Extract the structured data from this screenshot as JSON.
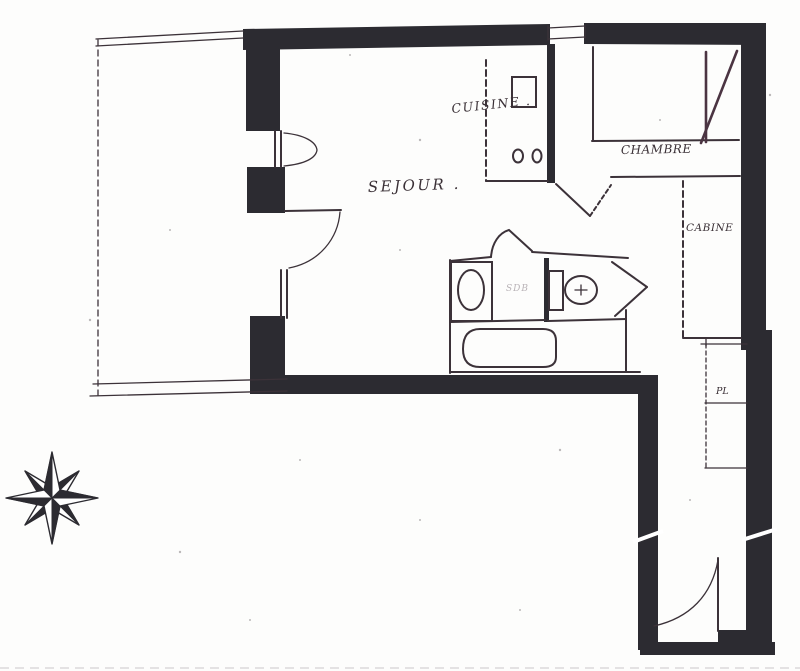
{
  "document": {
    "type": "apartment floor plan",
    "style": "hand-drawn photocopy"
  },
  "colors": {
    "paper": "#fdfdfc",
    "wall": "#2c2b31",
    "line": "#3c3239",
    "window": "#4b3442",
    "ink": "#3a3036",
    "faint": "#b9b3b7"
  },
  "labels": {
    "sejour": "SEJOUR .",
    "cuisine": "CUISINE .",
    "chambre": "CHAMBRE",
    "cabine": "CABINE",
    "bathroom_faint": "SDB",
    "closet": "PL"
  },
  "compass": {
    "type": "compass-rose",
    "points": 8
  }
}
